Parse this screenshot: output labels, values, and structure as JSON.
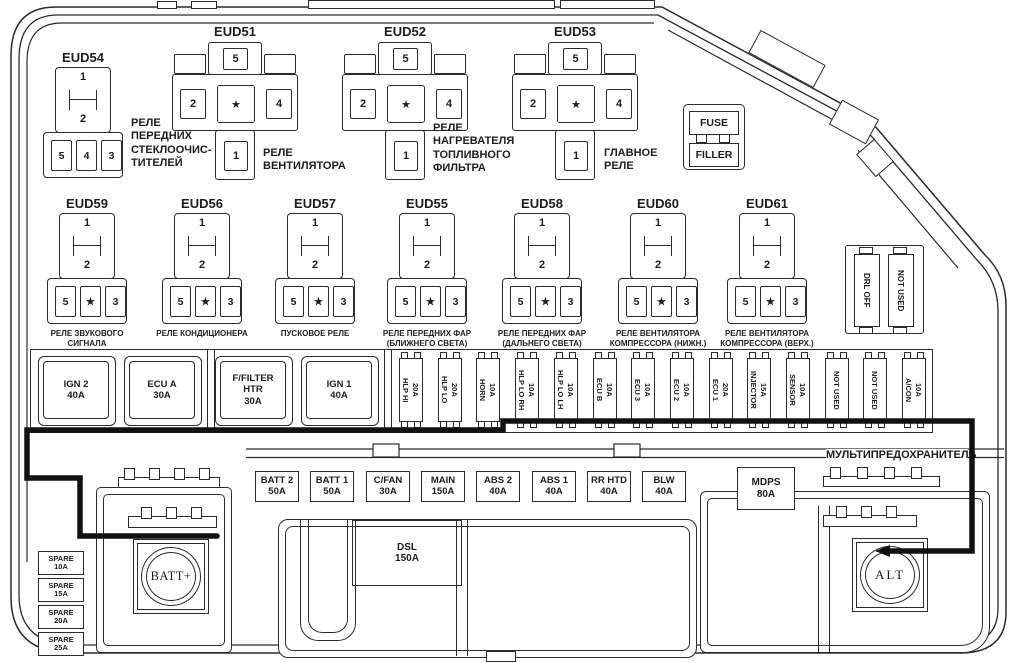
{
  "colors": {
    "line": "#2b2b2b",
    "thick_line": "#111111",
    "background": "#ffffff"
  },
  "relays": {
    "small": [
      {
        "id": "EUD54",
        "pins_top": [
          "1",
          "2"
        ],
        "pins_bottom": [
          "5",
          "4",
          "3"
        ],
        "caption": "РЕЛЕ\nПЕРЕДНИХ\nСТЕКЛООЧИС-\nТИТЕЛЕЙ"
      },
      {
        "id": "EUD59",
        "pins_top": [
          "1",
          "2"
        ],
        "pins_bottom": [
          "5",
          "★",
          "3"
        ],
        "caption": "РЕЛЕ ЗВУКОВОГО\nСИГНАЛА"
      },
      {
        "id": "EUD56",
        "pins_top": [
          "1",
          "2"
        ],
        "pins_bottom": [
          "5",
          "★",
          "3"
        ],
        "caption": "РЕЛЕ КОНДИЦИОНЕРА"
      },
      {
        "id": "EUD57",
        "pins_top": [
          "1",
          "2"
        ],
        "pins_bottom": [
          "5",
          "★",
          "3"
        ],
        "caption": "ПУСКОВОЕ РЕЛЕ"
      },
      {
        "id": "EUD55",
        "pins_top": [
          "1",
          "2"
        ],
        "pins_bottom": [
          "5",
          "★",
          "3"
        ],
        "caption": "РЕЛЕ ПЕРЕДНИХ ФАР\n(БЛИЖНЕГО СВЕТА)"
      },
      {
        "id": "EUD58",
        "pins_top": [
          "1",
          "2"
        ],
        "pins_bottom": [
          "5",
          "★",
          "3"
        ],
        "caption": "РЕЛЕ ПЕРЕДНИХ ФАР\n(ДАЛЬНЕГО СВЕТА)"
      },
      {
        "id": "EUD60",
        "pins_top": [
          "1",
          "2"
        ],
        "pins_bottom": [
          "5",
          "★",
          "3"
        ],
        "caption": "РЕЛЕ ВЕНТИЛЯТОРА\nКОМПРЕССОРА (НИЖН.)"
      },
      {
        "id": "EUD61",
        "pins_top": [
          "1",
          "2"
        ],
        "pins_bottom": [
          "5",
          "★",
          "3"
        ],
        "caption": "РЕЛЕ ВЕНТИЛЯТОРА\nКОМПРЕССОРА (ВЕРХ.)"
      }
    ],
    "cross": [
      {
        "id": "EUD51",
        "pins": {
          "top": "5",
          "left": "2",
          "center": "★",
          "right": "4",
          "bottom": "1"
        },
        "caption": "РЕЛЕ\nВЕНТИЛЯТОРА"
      },
      {
        "id": "EUD52",
        "pins": {
          "top": "5",
          "left": "2",
          "center": "★",
          "right": "4",
          "bottom": "1"
        },
        "caption": "РЕЛЕ\nНАГРЕВАТЕЛЯ\nТОПЛИВНОГО\nФИЛЬТРА"
      },
      {
        "id": "EUD53",
        "pins": {
          "top": "5",
          "left": "2",
          "center": "★",
          "right": "4",
          "bottom": "1"
        },
        "caption": "ГЛАВНОЕ\nРЕЛЕ"
      }
    ]
  },
  "fuse_filler": {
    "top": "FUSE",
    "bottom": "FILLER"
  },
  "drl_block": {
    "fuses": [
      "DRL OFF",
      "NOT USED"
    ]
  },
  "main_fuse_strip": {
    "large_fuses": [
      {
        "lines": "IGN 2\n40A"
      },
      {
        "lines": "ECU A\n30A"
      },
      {
        "lines": "F/FILTER\nHTR\n30A"
      },
      {
        "lines": "IGN 1\n40A"
      }
    ],
    "mini_fuses": [
      {
        "name": "HLP HI",
        "amp": "20A"
      },
      {
        "name": "HLP LO",
        "amp": "20A"
      },
      {
        "name": "HORN",
        "amp": "10A"
      },
      {
        "name": "HLP LO RH",
        "amp": "10A"
      },
      {
        "name": "HLP LO LH",
        "amp": "10A"
      },
      {
        "name": "ECU B",
        "amp": "10A"
      },
      {
        "name": "ECU 3",
        "amp": "10A"
      },
      {
        "name": "ECU 2",
        "amp": "10A"
      },
      {
        "name": "ECU 1",
        "amp": "20A"
      },
      {
        "name": "INJECTOR",
        "amp": "15A"
      },
      {
        "name": "SENSOR",
        "amp": "10A"
      },
      {
        "name": "NOT USED",
        "amp": ""
      },
      {
        "name": "NOT USED",
        "amp": ""
      },
      {
        "name": "A/CON",
        "amp": "10A"
      }
    ]
  },
  "bottom_fuse_row": [
    {
      "name": "BATT 2",
      "amp": "50A"
    },
    {
      "name": "BATT 1",
      "amp": "50A"
    },
    {
      "name": "C/FAN",
      "amp": "30A"
    },
    {
      "name": "MAIN",
      "amp": "150A"
    },
    {
      "name": "ABS 2",
      "amp": "40A"
    },
    {
      "name": "ABS 1",
      "amp": "40A"
    },
    {
      "name": "RR HTD",
      "amp": "40A"
    },
    {
      "name": "BLW",
      "amp": "40A"
    }
  ],
  "mdps_fuse": {
    "name": "MDPS",
    "amp": "80A"
  },
  "dsl_fuse": {
    "name": "DSL",
    "amp": "150A"
  },
  "multifuse_label": "МУЛЬТИПРЕДОХРАНИТЕЛЬ",
  "spare_fuses": [
    {
      "name": "SPARE",
      "amp": "10A"
    },
    {
      "name": "SPARE",
      "amp": "15A"
    },
    {
      "name": "SPARE",
      "amp": "20A"
    },
    {
      "name": "SPARE",
      "amp": "25A"
    }
  ],
  "terminals": {
    "battery": "BATT+",
    "alternator": "ALT"
  }
}
